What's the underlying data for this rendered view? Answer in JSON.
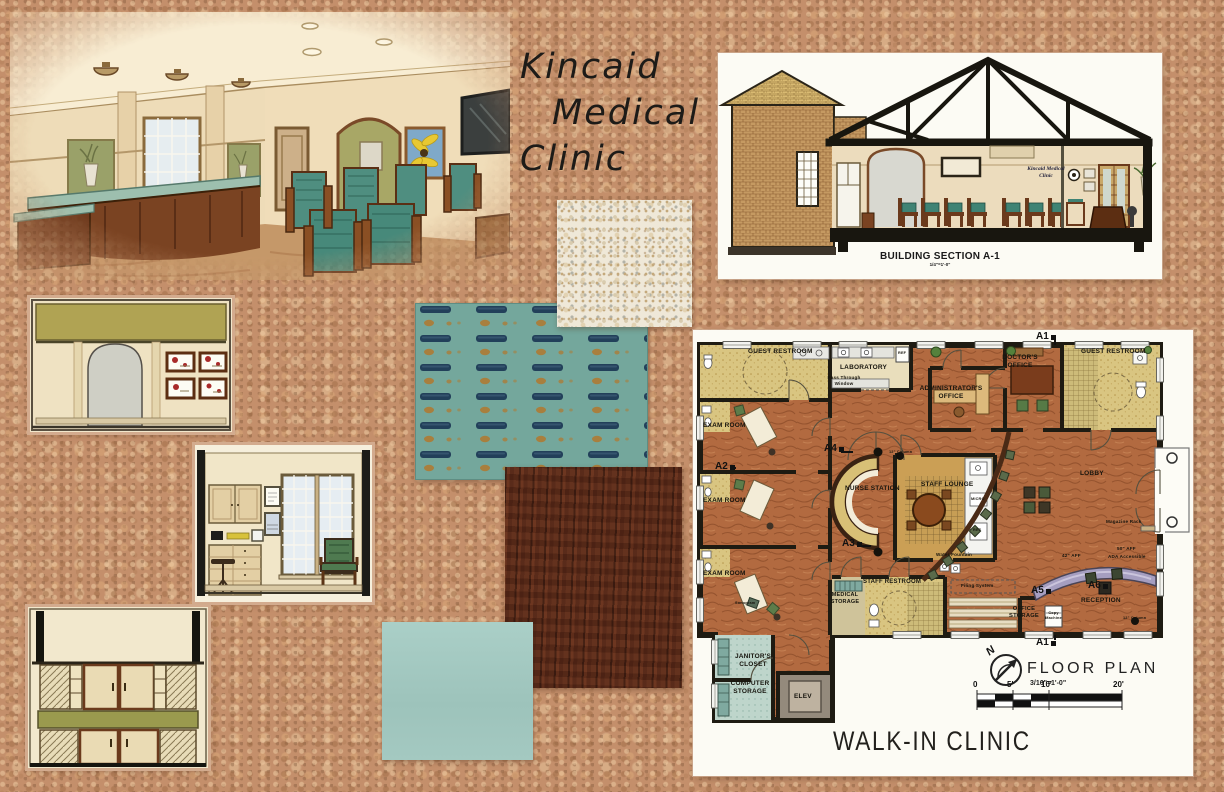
{
  "board": {
    "title": [
      "Kincaid",
      "Medical",
      "Clinic"
    ],
    "project_title": "WALK-IN CLINIC"
  },
  "building_section": {
    "caption": "BUILDING SECTION A-1",
    "scale": "1/4\"=1'-0\"",
    "wall_sign": "Kincaid Medical\nClinic"
  },
  "floor_plan": {
    "caption": "FLOOR PLAN",
    "scale": "3/16\"=1'-0\"",
    "north": "N",
    "scale_ticks": [
      "0",
      "5'",
      "10'",
      "20'"
    ],
    "markers": {
      "a1_top": "A1",
      "a1_bottom": "A1",
      "a2": "A2",
      "a3": "A3",
      "a4": "A4",
      "a5": "A5",
      "a6": "A6"
    },
    "rooms": {
      "guest_restroom_left": "GUEST RESTROOM",
      "laboratory": "LABORATORY",
      "exam_room_1": "EXAM ROOM",
      "exam_room_2": "EXAM ROOM",
      "exam_room_3": "EXAM ROOM",
      "administrators_office": "ADMINISTRATOR'S\nOFFICE",
      "doctors_office": "DOCTOR'S\nOFFICE",
      "guest_restroom_right": "GUEST RESTROOM",
      "nurse_station": "NURSE STATION",
      "staff_lounge": "STAFF LOUNGE",
      "lobby": "LOBBY",
      "reception": "RECEPTION",
      "medical_storage": "MEDICAL\nSTORAGE",
      "staff_restroom": "STAFF RESTROOM",
      "office_storage": "OFFICE\nSTORAGE",
      "janitors_closet": "JANITOR'S\nCLOSET",
      "computer_storage": "COMPUTER\nSTORAGE",
      "elevator": "ELEV"
    },
    "annotations": {
      "pass_through": "Pass Through\nWindow",
      "ref_lab": "REF",
      "micro": "MICRO",
      "ref_lounge": "REF",
      "water_fountain": "Water Fountain",
      "magazine_rack": "Magazine Rack",
      "filing_system": "Filing System",
      "copy_machine": "Copy\nMachine",
      "sonogram": "Sonogram",
      "column_12_top": "12\" Column",
      "column_12_bottom": "12\" Column",
      "aff_42": "42\" AFF",
      "aff_50": "50\" AFF",
      "ada": "ADA Accessible"
    }
  },
  "colors": {
    "cork": "#c48f6b",
    "swatch_terrazzo": "#efe8d8",
    "swatch_fabric_base": "#74a79c",
    "swatch_fabric_dash": "#22405a",
    "swatch_fabric_dot": "#a87f3e",
    "swatch_wood": "#5a2b1a",
    "swatch_paint": "#a4c9c1",
    "plan_floor": "#b26a40",
    "plan_room_tan": "#d9c581"
  }
}
